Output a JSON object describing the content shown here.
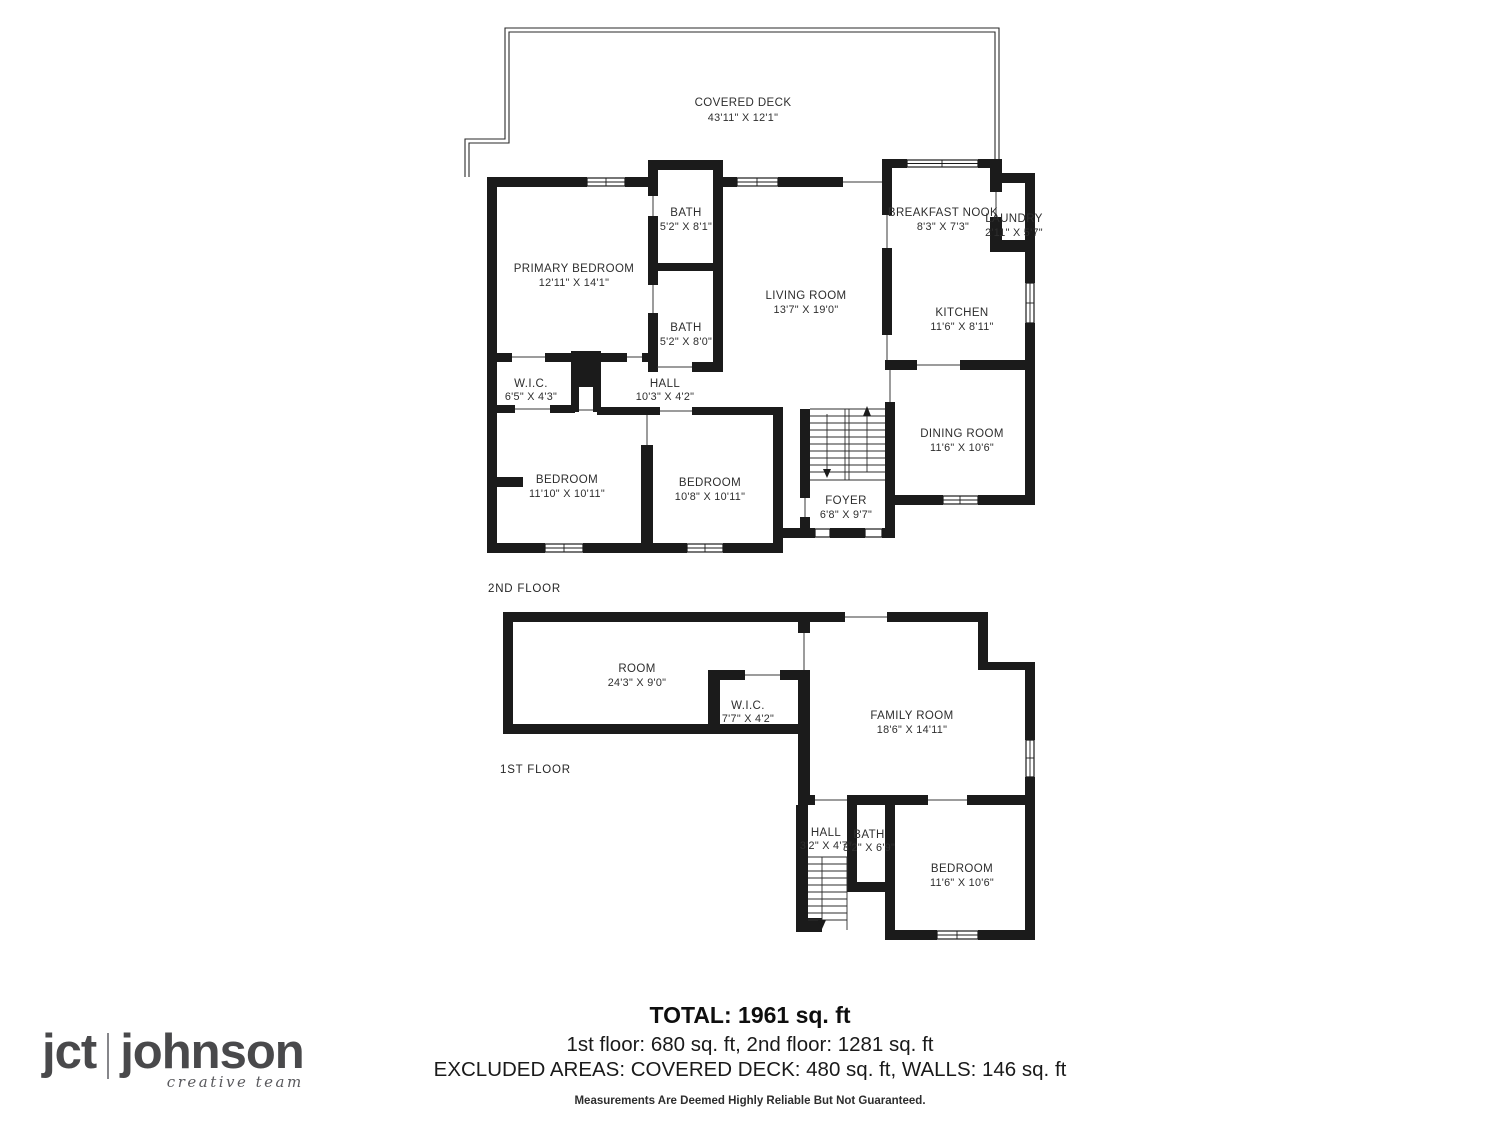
{
  "floor2": {
    "title": "2ND FLOOR",
    "deck": {
      "name": "COVERED DECK",
      "dims": "43'11\" X 12'1\""
    },
    "rooms": {
      "primary_bedroom": {
        "name": "PRIMARY BEDROOM",
        "dims": "12'11\" X 14'1\""
      },
      "bath_upper": {
        "name": "BATH",
        "dims": "5'2\" X 8'1\""
      },
      "bath_lower": {
        "name": "BATH",
        "dims": "5'2\" X 8'0\""
      },
      "living_room": {
        "name": "LIVING ROOM",
        "dims": "13'7\" X 19'0\""
      },
      "breakfast_nook": {
        "name": "BREAKFAST NOOK",
        "dims": "8'3\" X 7'3\""
      },
      "laundry": {
        "name": "LAUNDRY",
        "dims": "2'11\" X 5'7\""
      },
      "kitchen": {
        "name": "KITCHEN",
        "dims": "11'6\" X 8'11\""
      },
      "dining_room": {
        "name": "DINING ROOM",
        "dims": "11'6\" X 10'6\""
      },
      "wic": {
        "name": "W.I.C.",
        "dims": "6'5\" X 4'3\""
      },
      "hall": {
        "name": "HALL",
        "dims": "10'3\" X 4'2\""
      },
      "bedroom_left": {
        "name": "BEDROOM",
        "dims": "11'10\" X 10'11\""
      },
      "bedroom_mid": {
        "name": "BEDROOM",
        "dims": "10'8\" X 10'11\""
      },
      "foyer": {
        "name": "FOYER",
        "dims": "6'8\" X 9'7\""
      }
    }
  },
  "floor1": {
    "title": "1ST FLOOR",
    "rooms": {
      "room": {
        "name": "ROOM",
        "dims": "24'3\" X 9'0\""
      },
      "wic": {
        "name": "W.I.C.",
        "dims": "7'7\" X 4'2\""
      },
      "family_room": {
        "name": "FAMILY ROOM",
        "dims": "18'6\" X 14'11\""
      },
      "hall": {
        "name": "HALL",
        "dims": "3'2\" X 4'7\""
      },
      "bath": {
        "name": "BATH",
        "dims": "3'2\" X 6'9\""
      },
      "bedroom": {
        "name": "BEDROOM",
        "dims": "11'6\" X 10'6\""
      }
    }
  },
  "footer": {
    "total": "TOTAL: 1961 sq. ft",
    "floors_line": "1st floor: 680 sq. ft, 2nd floor: 1281 sq. ft",
    "excluded_line": "EXCLUDED AREAS: COVERED DECK: 480 sq. ft, WALLS: 146 sq. ft",
    "disclaimer": "Measurements Are Deemed Highly Reliable But Not Guaranteed."
  },
  "logo": {
    "mark": "jct",
    "name": "johnson",
    "tagline": "creative team"
  }
}
